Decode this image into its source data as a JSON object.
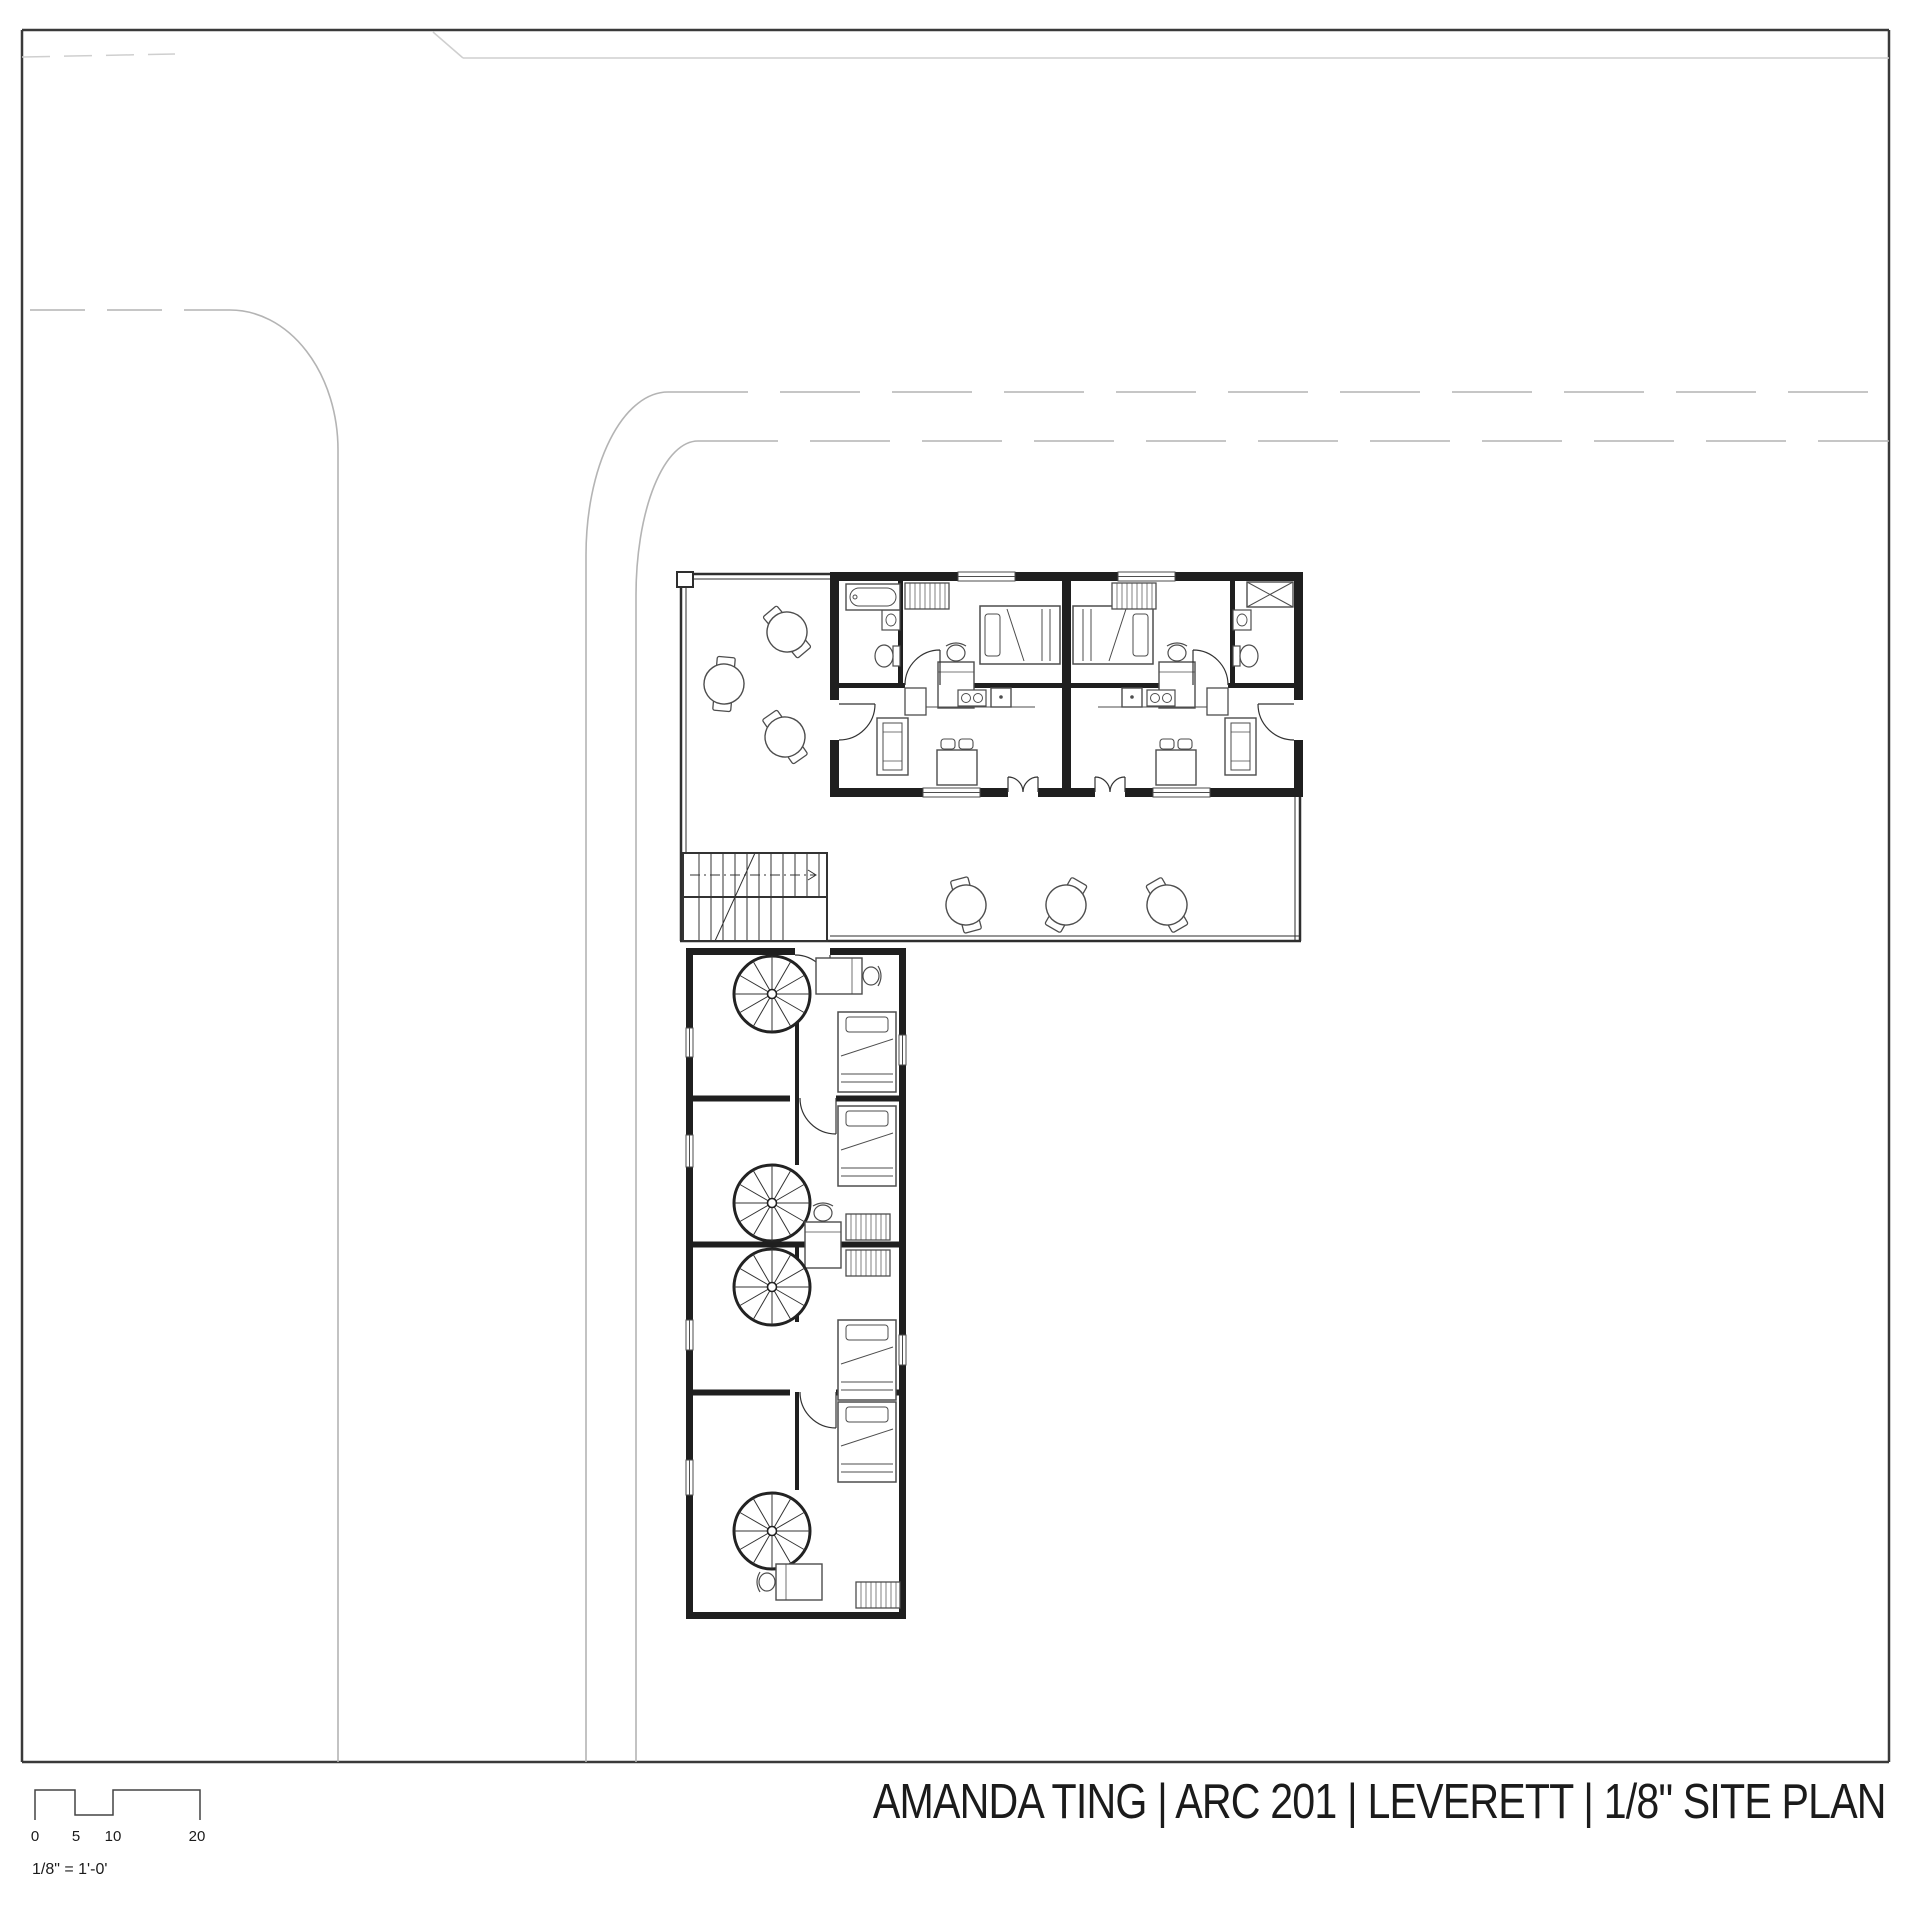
{
  "title_block": {
    "title": "AMANDA TING | ARC 201 | LEVERETT | 1/8\" SITE PLAN"
  },
  "scale_bar": {
    "ticks": [
      "0",
      "5",
      "10",
      "20"
    ],
    "note": "1/8\" = 1'-0'"
  },
  "plan": {
    "type": "architectural site plan, 1/8 inch scale",
    "building_units": 2,
    "wing_rooms": 4,
    "spiral_stairs": 4,
    "straight_stairs": 1,
    "patio_round_tables": 3,
    "deck_round_tables": 3
  },
  "colors": {
    "sheet_border": "#3a3a3a",
    "walls": "#1f1f1f",
    "furniture": "#4d4d4d",
    "roads": "#b4b4b4",
    "site_boundary": "#cfcfcf",
    "text": "#1b1b1b"
  }
}
